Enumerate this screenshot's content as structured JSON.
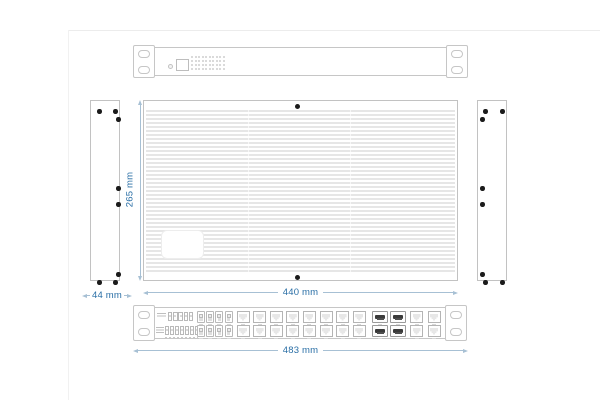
{
  "drawing": {
    "dimensions": {
      "top_view_depth": "265 mm",
      "top_view_width": "440 mm",
      "side_view_width": "44 mm",
      "front_view_width": "483 mm"
    },
    "colors": {
      "dimension_text": "#2a6fa6",
      "dimension_line": "#a7c0d4",
      "outline": "#c6c6c6",
      "fin_stripe": "#e6e6e6",
      "screw": "#1b1b1b",
      "dark_slot": "#3a3a3a"
    },
    "rear_panel": {
      "vent_grid": {
        "rows": 4,
        "cols": 10
      }
    },
    "side_panels": {
      "mounting_holes_each": 8
    },
    "front_panel": {
      "terminal_top_cells": 5,
      "terminal_bottom_cells": 7,
      "sfp_cages_left": {
        "rows": 2,
        "cols": 4
      },
      "rj45_main": {
        "rows": 2,
        "cols": 8
      },
      "sfp_cages_right": {
        "rows": 2,
        "cols": 2
      },
      "rj45_right": {
        "rows": 2,
        "cols": 2
      }
    }
  }
}
